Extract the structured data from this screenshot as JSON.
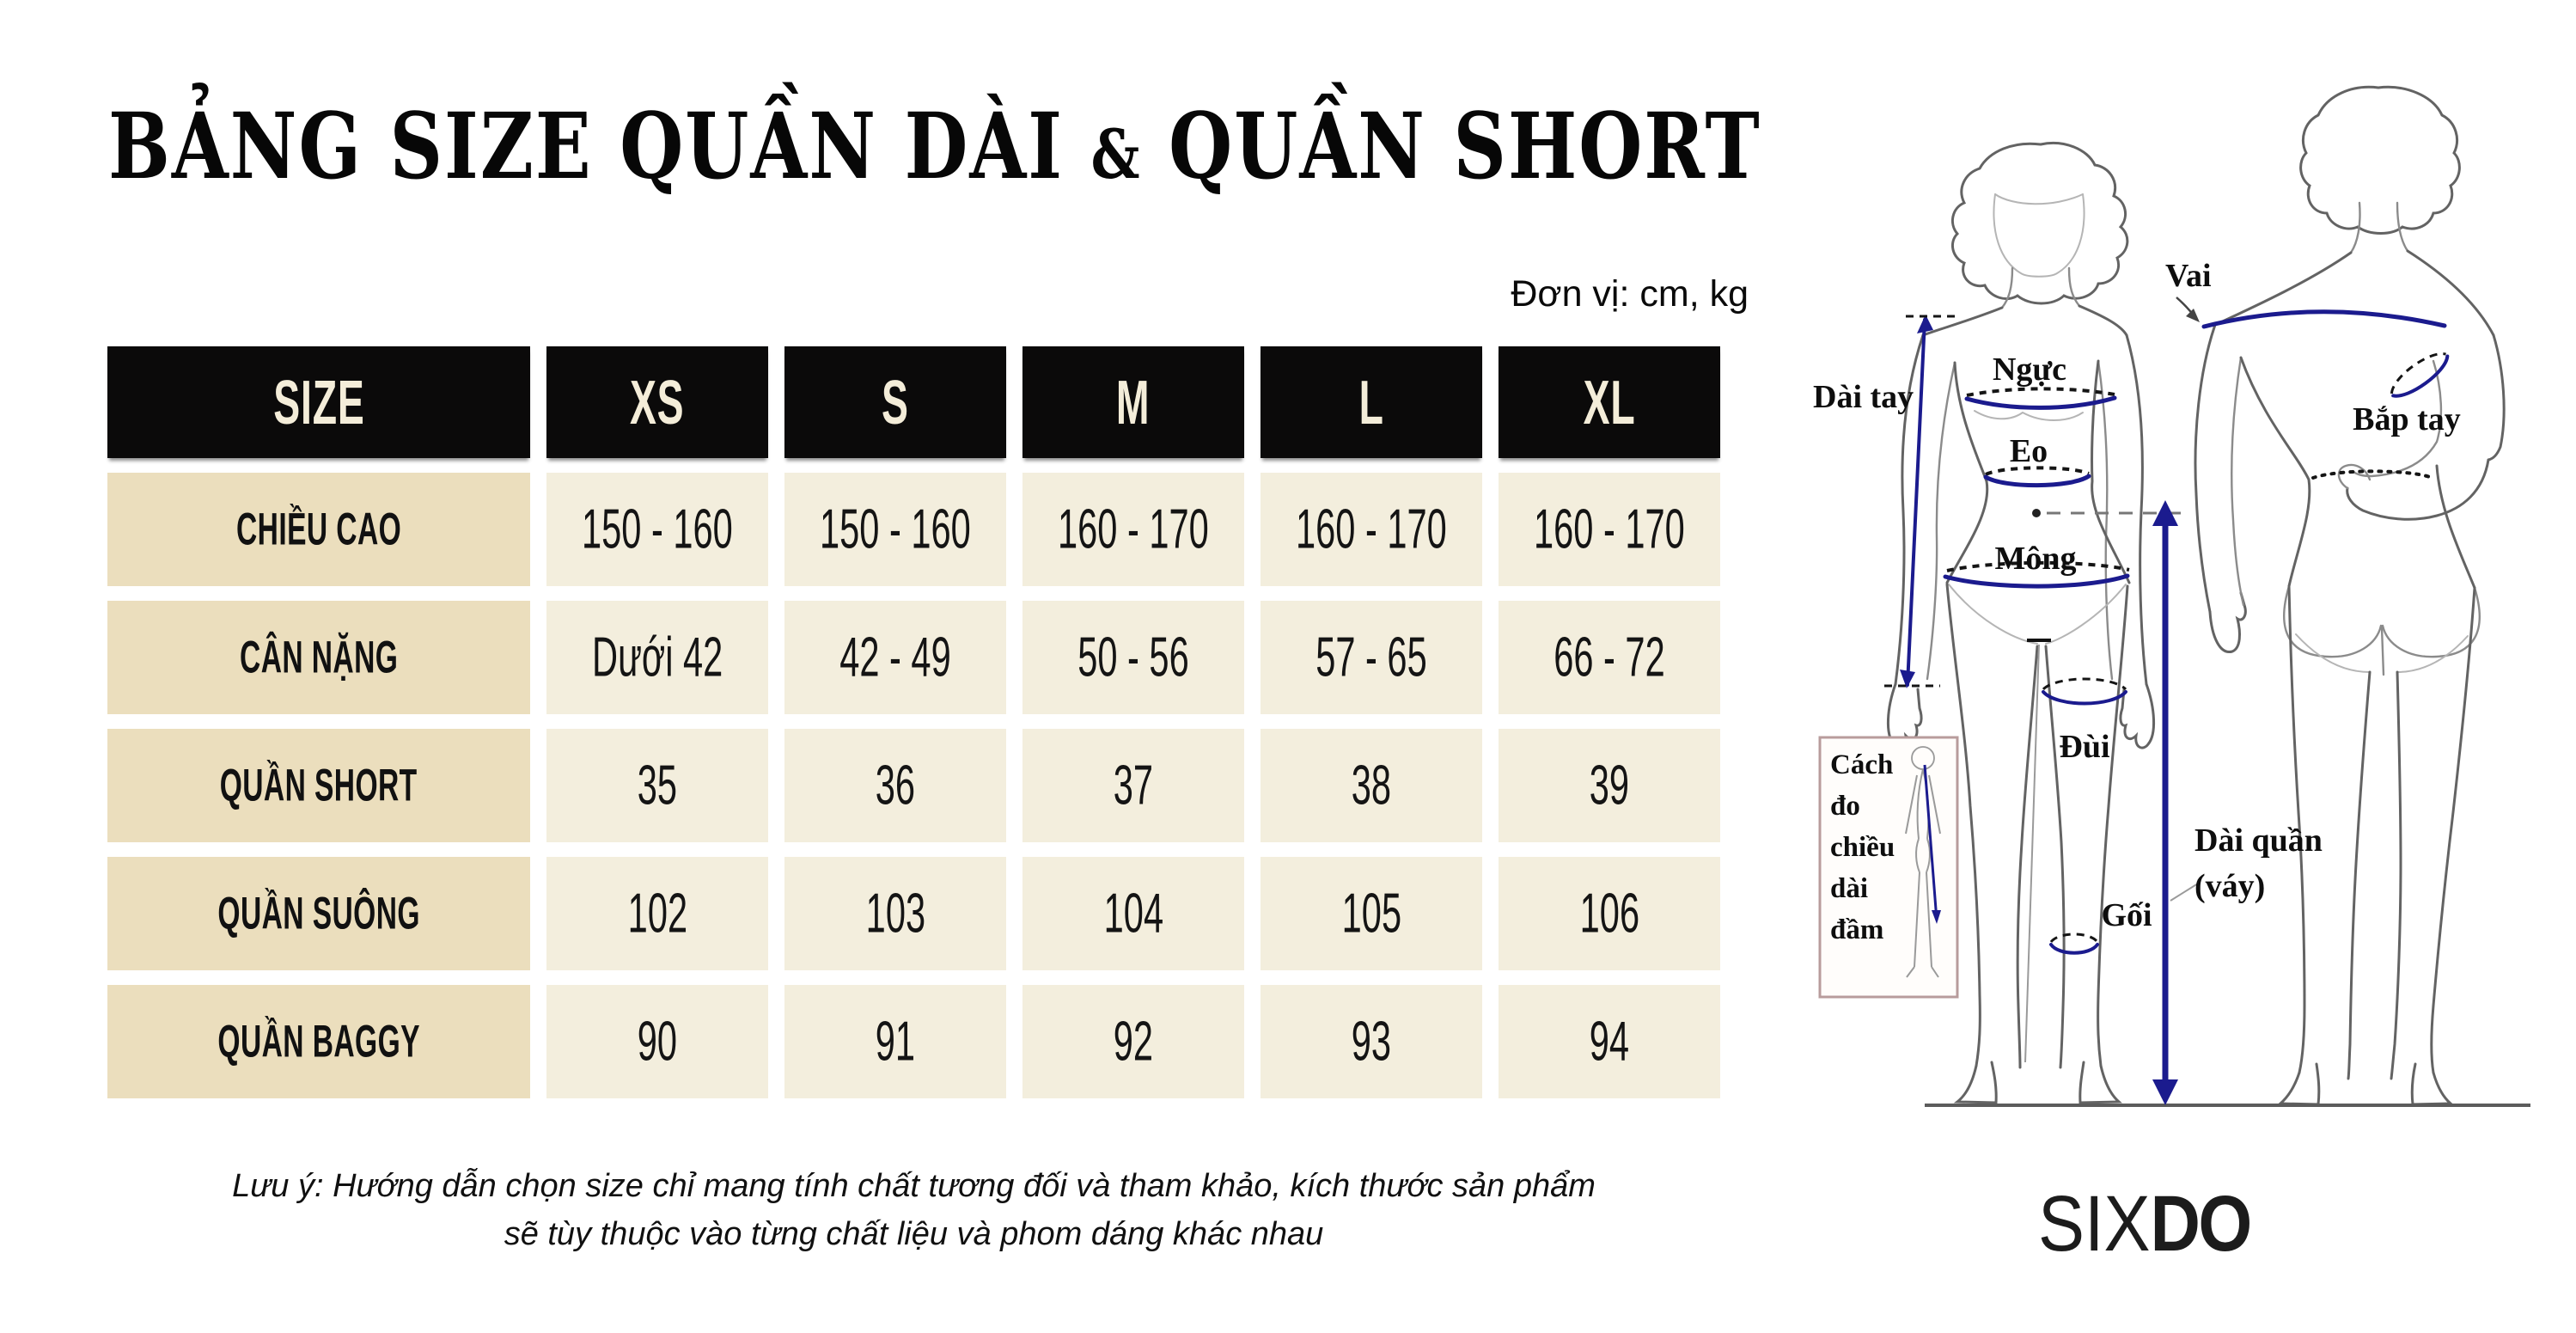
{
  "title": {
    "part1": "BẢNG SIZE QUẦN DÀI ",
    "amp": "&",
    "part2": " QUẦN SHORT"
  },
  "unit_note": "Đơn vị: cm, kg",
  "table": {
    "headers": [
      "SIZE",
      "XS",
      "S",
      "M",
      "L",
      "XL"
    ],
    "rows": [
      {
        "label": "CHIỀU CAO",
        "values": [
          "150 - 160",
          "150 - 160",
          "160 - 170",
          "160 - 170",
          "160 - 170"
        ]
      },
      {
        "label": "CÂN NẶNG",
        "values": [
          "Dưới 42",
          "42 - 49",
          "50 - 56",
          "57 - 65",
          "66 - 72"
        ]
      },
      {
        "label": "QUẦN SHORT",
        "values": [
          "35",
          "36",
          "37",
          "38",
          "39"
        ]
      },
      {
        "label": "QUẦN SUÔNG",
        "values": [
          "102",
          "103",
          "104",
          "105",
          "106"
        ]
      },
      {
        "label": "QUẦN BAGGY",
        "values": [
          "90",
          "91",
          "92",
          "93",
          "94"
        ]
      }
    ]
  },
  "footnote": {
    "line1": "Lưu ý: Hướng dẫn chọn size chỉ mang tính chất tương đối và tham khảo, kích thước sản phẩm",
    "line2": "sẽ tùy thuộc vào từng chất liệu và phom dáng khác nhau"
  },
  "diagram": {
    "labels": {
      "vai": "Vai",
      "dai_tay": "Dài tay",
      "nguc": "Ngực",
      "eo": "Eo",
      "mong": "Mông",
      "dui": "Đùi",
      "goi": "Gối",
      "bap_tay": "Bắp tay",
      "dai_quan_line1": "Dài quần",
      "dai_quan_line2": "(váy)",
      "inset_line1": "Cách",
      "inset_line2": "đo",
      "inset_line3": "chiều",
      "inset_line4": "dài",
      "inset_line5": "đầm"
    }
  },
  "logo": {
    "part1": "SIX",
    "part2": "DO"
  },
  "colors": {
    "header_bg": "#0b0a0a",
    "header_text": "#f4edd9",
    "label_cell_bg": "#ebdebd",
    "value_cell_bg": "#f3eedd",
    "measure_line": "#1b1b8e",
    "sketch_outline": "#8b8b8b"
  }
}
